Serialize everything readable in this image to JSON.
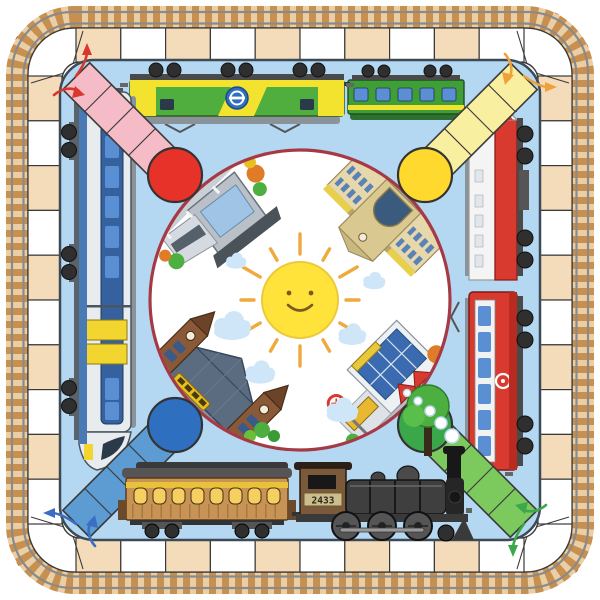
{
  "board": {
    "kind": "train-themed-ludo-game-mat",
    "loco_number": "2433",
    "ring_cells_per_side": 10,
    "players": [
      {
        "id": "red",
        "corner": "top-left",
        "path_cells": 4,
        "path_color": "#f5bcc8",
        "start_circle_color": "#e63229",
        "arrow_color": "#d9362c"
      },
      {
        "id": "yellow",
        "corner": "top-right",
        "path_cells": 4,
        "path_color": "#f8f0a0",
        "start_circle_color": "#ffd92e",
        "arrow_color": "#f0a23a"
      },
      {
        "id": "green",
        "corner": "bottom-right",
        "path_cells": 4,
        "path_color": "#7cc95e",
        "start_circle_color": "#3aa84a",
        "arrow_color": "#3da84a"
      },
      {
        "id": "blue",
        "corner": "bottom-left",
        "path_cells": 4,
        "path_color": "#5d9bd3",
        "start_circle_color": "#2e6fc0",
        "arrow_color": "#3a6fc4"
      }
    ],
    "trains": {
      "top": [
        "green-yellow-electric-locomotive",
        "green-passenger-car"
      ],
      "left": [
        "blue-modern-emu-trainset"
      ],
      "right": [
        "white-red-diesel-locomotive",
        "red-electric-locomotive"
      ],
      "bottom": [
        "vintage-wooden-coach",
        "black-steam-locomotive"
      ]
    },
    "center": {
      "sun": "smiling-sun",
      "stations": [
        "modern-terminal-station-top-left",
        "classic-grand-station-top-right",
        "historic-twin-tower-station-bottom-left",
        "suburban-glass-station-bottom-right"
      ]
    }
  },
  "colors": {
    "page_bg": "#ffffff",
    "track_base": "#eacfa6",
    "track_sleeper": "#c8904f",
    "rail": "#8a8a8a",
    "bolt": "#7a4a22",
    "ring_cream": "#f4dcba",
    "ring_white": "#ffffff",
    "ring_border": "#3a3a3a",
    "field_blue": "#b5d8f2",
    "field_outline": "#3d4a56",
    "hub_fill": "#ffffff",
    "hub_border": "#a63a44",
    "sun": "#ffe23a",
    "sun_ray": "#efa93c",
    "sun_face": "#7a5a20",
    "cloud_blue": "#cfe6f8",
    "cloud_white": "#ffffff",
    "path_pink": "#f5bcc8",
    "start_red": "#e63229",
    "arrow_red": "#d9362c",
    "path_yellow": "#f8f0a0",
    "start_yellow": "#ffd92e",
    "arrow_orange": "#f0a23a",
    "path_blue": "#5d9bd3",
    "start_blue": "#2e6fc0",
    "arrow_blue": "#3a6fc4",
    "path_green": "#7cc95e",
    "start_green": "#3aa84a",
    "arrow_green": "#3da84a",
    "loco_green": "#4fae3d",
    "band_yellow": "#f3e32f",
    "coach_green": "#3f9e37",
    "window_blue": "#5b8fd4",
    "emu_body": "#e8ecef",
    "emu_band": "#35619f",
    "emu_yellow": "#f3d530",
    "diesel_red": "#d93a30",
    "eloco_red": "#d93a30",
    "steam_body": "#3f3f3f",
    "steam_cab": "#7a5a3a",
    "coach_brown": "#c89455",
    "coach_window_yellow": "#f5d060",
    "wheel_dark": "#2f2f2f",
    "roof_gray": "#8a929a",
    "tree_green": "#4caf3f",
    "tree_orange": "#e07b28"
  }
}
